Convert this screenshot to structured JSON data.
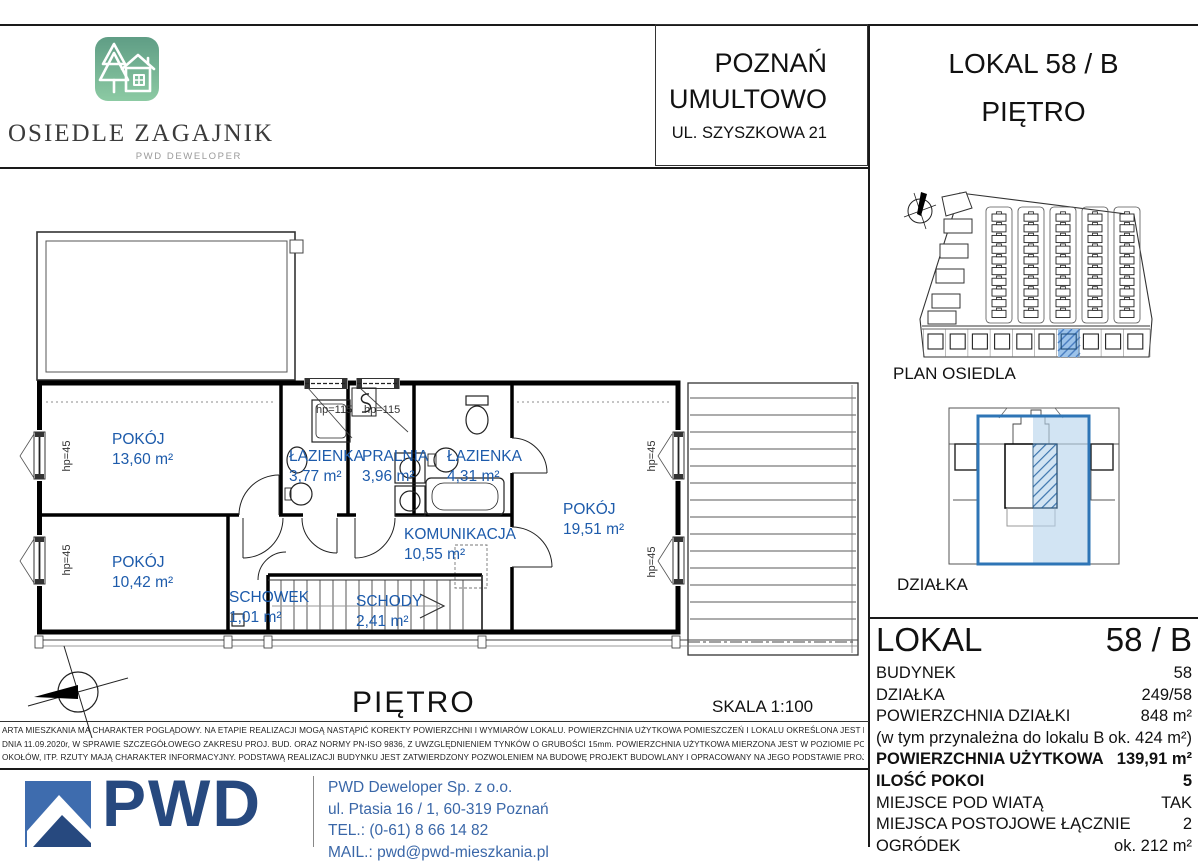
{
  "header": {
    "brand": {
      "name": "OSIEDLE ZAGAJNIK",
      "subtitle": "PWD DEWELOPER"
    },
    "location": {
      "city": "POZNAŃ",
      "district": "UMULTOWO",
      "street": "UL. SZYSZKOWA 21"
    },
    "unit": {
      "line1": "LOKAL 58 / B",
      "line2": "PIĘTRO"
    }
  },
  "floorplan": {
    "title": "PIĘTRO",
    "scale": "SKALA  1:100",
    "rooms": [
      {
        "name": "POKÓJ",
        "area": "13,60 m²"
      },
      {
        "name": "ŁAZIENKA",
        "area": "3,77 m²"
      },
      {
        "name": "PRALNIA",
        "area": "3,96 m²"
      },
      {
        "name": "ŁAZIENKA",
        "area": "4,31 m²"
      },
      {
        "name": "POKÓJ",
        "area": "19,51 m²"
      },
      {
        "name": "KOMUNIKACJA",
        "area": "10,55 m²"
      },
      {
        "name": "POKÓJ",
        "area": "10,42 m²"
      },
      {
        "name": "SCHOWEK",
        "area": "1,01 m²"
      },
      {
        "name": "SCHODY",
        "area": "2,41 m²"
      }
    ],
    "window_labels": {
      "hp_45": "hp=45",
      "hp_115": "hp=115"
    }
  },
  "side_panel": {
    "site_plan_label": "PLAN OSIEDLA",
    "plot_label": "DZIAŁKA",
    "unit_table": {
      "title": "LOKAL",
      "title_value": "58 / B",
      "rows": [
        {
          "label": "BUDYNEK",
          "value": "58"
        },
        {
          "label": "DZIAŁKA",
          "value": "249/58"
        },
        {
          "label": "POWIERZCHNIA DZIAŁKI",
          "value": "848 m²"
        },
        {
          "label": "(w tym przynależna do lokalu B",
          "value": "ok. 424 m²)"
        },
        {
          "label": "POWIERZCHNIA UŻYTKOWA",
          "value": "139,91 m²"
        },
        {
          "label": "ILOŚĆ POKOI",
          "value": "5"
        },
        {
          "label": "MIEJSCE POD WIATĄ",
          "value": "TAK"
        },
        {
          "label": "MIEJSCA POSTOJOWE ŁĄCZNIE",
          "value": "2"
        },
        {
          "label": "OGRÓDEK",
          "value": "ok. 212 m²"
        }
      ]
    }
  },
  "disclaimer": {
    "line1": "ARTA MIESZKANIA MA CHARAKTER POGLĄDOWY.    NA ETAPIE REALIZACJI MOGĄ NASTĄPIĆ KOREKTY POWIERZCHNI I WYMIARÓW LOKALU.    POWIERZCHNIA  UŻYTKOWA POMIESZCZEŃ I LOKALU OKREŚLONA JEST NA PODSTAWIE ROZP. MIN. ROZW.",
    "line2": "DNIA 11.09.2020r,  W SPRAWIE SZCZEGÓŁOWEGO ZAKRESU PROJ. BUD. ORAZ NORMY PN-ISO 9836, Z UWZGLĘDNIENIEM TYNKÓW O GRUBOŚCI 15mm.   POWIERZCHNIA UŻYTKOWA MIERZONA JEST W POZIOMIE PODŁOGI BEZ UWZGLĘDNIENIA LISTEW,",
    "line3": "OKOŁÓW, ITP.   RZUTY  MAJĄ  CHARAKTER  INFORMACYJNY.   PODSTAWĄ REALIZACJI BUDYNKU JEST ZATWIERDZONY POZWOLENIEM NA BUDOWĘ PROJEKT BUDOWLANY I OPRACOWANY NA JEGO PODSTAWIE  PROJEKT TECHNICZNY I WYKONAWCZY."
  },
  "footer": {
    "logo_text": "PWD",
    "company": "PWD Deweloper Sp. z o.o.",
    "address": "ul. Ptasia 16 / 1, 60-319 Poznań",
    "phone": "TEL.:  (0-61) 8 66 14 82",
    "email": "MAIL.: pwd@pwd-mieszkania.pl"
  },
  "colors": {
    "room_label_blue": "#1d5bab",
    "highlight_fill": "#bdd7ee",
    "highlight_stroke": "#2e75b6",
    "logo_green_top": "#5f9d85",
    "logo_green_bottom": "#8ccaa3",
    "pwd_blue": "#3e6cae",
    "pwd_dark_blue": "#27497f",
    "contact_blue": "#3a67a8"
  }
}
